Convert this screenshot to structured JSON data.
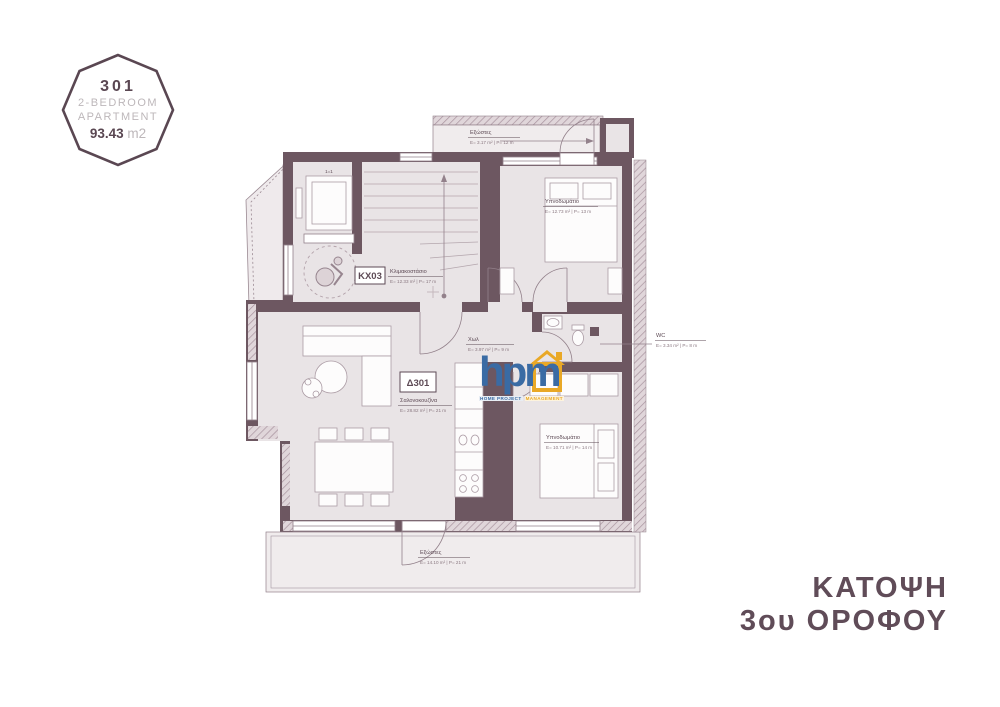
{
  "badge": {
    "number": "301",
    "line1": "2-BEDROOM",
    "line2": "APARTMENT",
    "area": "93.43",
    "area_unit": "m2"
  },
  "title": {
    "line1": "ΚΑΤΟΨΗ",
    "line2": "3ου ΟΡΟΦΟΥ"
  },
  "logo": {
    "text": "hpm",
    "tagline_left": "HOME PROJECT",
    "tagline_right": "MANAGEMENT"
  },
  "plan": {
    "codes": {
      "core": "ΚΧ03",
      "unit": "Δ301",
      "elevator": "1=1"
    },
    "rooms": {
      "balcony_top": {
        "name": "Εξώστες",
        "metrics": "Ε= 3.17 m² | Ρ= 12 m"
      },
      "bedroom_top": {
        "name": "Υπνοδωμάτιο",
        "metrics": "Ε= 12.73 m² | Ρ= 13 m"
      },
      "stairwell": {
        "name": "Κλιμακοστάσιο",
        "metrics": "Ε= 12.33 m² | Ρ= 17 m"
      },
      "hall": {
        "name": "Χωλ",
        "metrics": "Ε= 3.97 m² | Ρ= 9 m"
      },
      "wc": {
        "name": "WC",
        "metrics": "Ε= 3.34 m² | Ρ= 8 m"
      },
      "living": {
        "name": "Σαλονοκουζίνα",
        "metrics": "Ε= 28.82 m² | Ρ= 21 m"
      },
      "bedroom_bottom": {
        "name": "Υπνοδωμάτιο",
        "metrics": "Ε= 10.71 m² | Ρ= 14 m"
      },
      "balcony_bottom": {
        "name": "Εξώστες",
        "metrics": "Ε= 14.10 m² | Ρ= 21 m"
      }
    },
    "colors": {
      "wall": "#6d5761",
      "room_fill": "#e9e4e6",
      "balcony_fill": "#f0eced",
      "ink": "#5d4a55",
      "muted": "#bdb7ba",
      "logo_blue": "#3a6ba4",
      "logo_yellow": "#e9a826"
    }
  }
}
